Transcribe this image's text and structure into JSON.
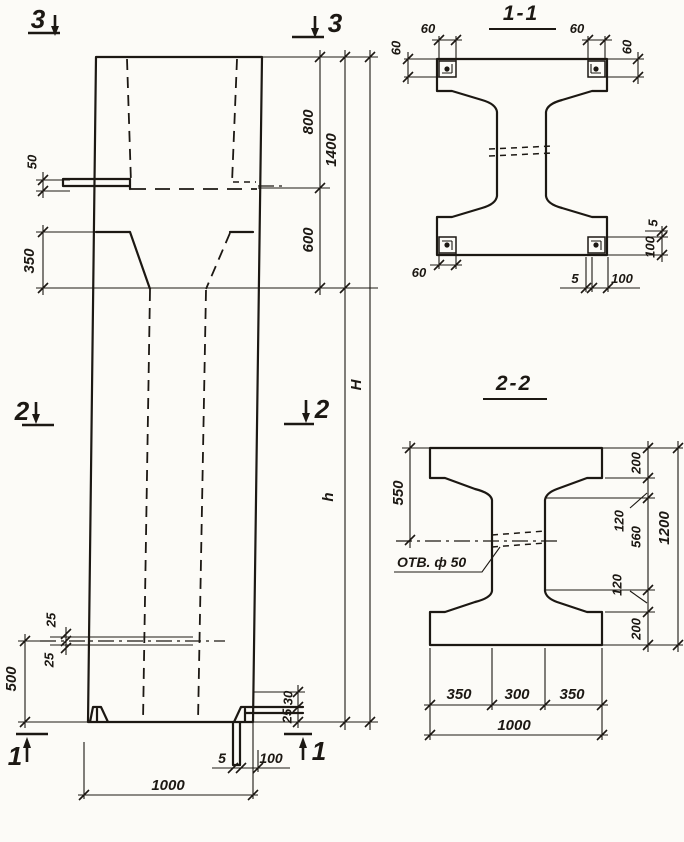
{
  "meta": {
    "ink": "#1c1813",
    "paper": "#fcfbf7"
  },
  "elevation": {
    "marks": {
      "top_left": "3",
      "top_right": "3",
      "mid_left": "2",
      "mid_right": "2",
      "bottom_left": "1",
      "bottom_right": "1"
    },
    "dims": {
      "ledge_thickness": "50",
      "haunch_height": "350",
      "head_height": "800",
      "taper_height": "600",
      "head_total": "1400",
      "height_total": "H",
      "height_shaft": "h",
      "hole_off_top": "25",
      "hole_off_bot": "25",
      "hole_level": "500",
      "foot_step_top": "30",
      "foot_step_bot": "25",
      "base_plate_thk": "5",
      "base_plate_len": "100",
      "base_width": "1000"
    }
  },
  "section1": {
    "title": "1-1",
    "dims": {
      "tl_w": "60",
      "tl_h": "60",
      "tr_w": "60",
      "tr_h": "60",
      "bl_w": "60",
      "br_gap": "5",
      "br_len": "100",
      "side_gap": "5",
      "side_len": "100"
    }
  },
  "section2": {
    "title": "2-2",
    "hole_note": "ОТВ. ф 50",
    "dims": {
      "left_550": "550",
      "r_200t": "200",
      "r_120t": "120",
      "r_560": "560",
      "r_120b": "120",
      "r_200b": "200",
      "r_1200": "1200",
      "b_350l": "350",
      "b_300": "300",
      "b_350r": "350",
      "b_1000": "1000"
    }
  }
}
